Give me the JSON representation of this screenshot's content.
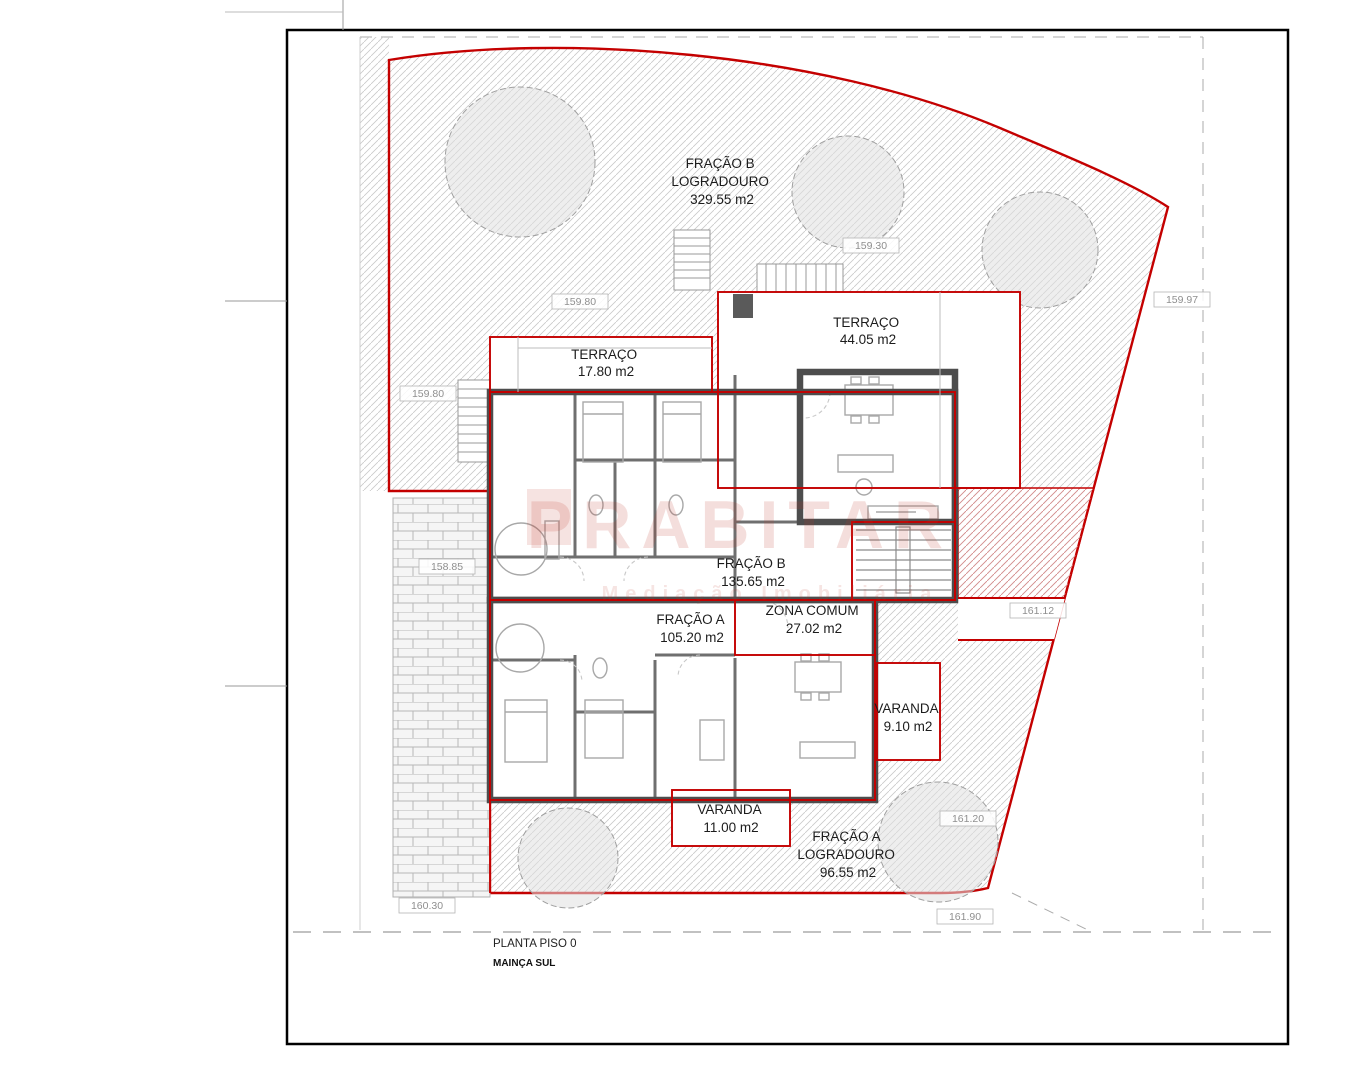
{
  "drawing": {
    "title_block": {
      "line1": "PLANTA PISO 0",
      "line2": "MAINÇA SUL"
    },
    "watermark": {
      "text": "PRABITAR",
      "subtext": "Mediação Imobiliária"
    },
    "areas": [
      {
        "name": "fracao-b-logradouro",
        "lines": [
          "FRAÇÃO B",
          "LOGRADOURO",
          "329.55 m2"
        ]
      },
      {
        "name": "terraco-fracao-b",
        "lines": [
          "TERRAÇO",
          "44.05 m2"
        ]
      },
      {
        "name": "terraco-fracao-b-2",
        "lines": [
          "TERRAÇO",
          "17.80 m2"
        ]
      },
      {
        "name": "fracao-b",
        "lines": [
          "FRAÇÃO B",
          "135.65 m2"
        ]
      },
      {
        "name": "zona-comum",
        "lines": [
          "ZONA COMUM",
          "27.02 m2"
        ]
      },
      {
        "name": "fracao-a",
        "lines": [
          "FRAÇÃO A",
          "105.20 m2"
        ]
      },
      {
        "name": "varanda-fracao-b",
        "lines": [
          "VARANDA",
          "9.10 m2"
        ]
      },
      {
        "name": "varanda-fracao-a",
        "lines": [
          "VARANDA",
          "11.00 m2"
        ]
      },
      {
        "name": "fracao-a-logradouro",
        "lines": [
          "FRAÇÃO A",
          "LOGRADOURO",
          "96.55 m2"
        ]
      }
    ],
    "elevations": [
      "159.30",
      "159.80",
      "159.97",
      "159.80",
      "158.85",
      "161.12",
      "161.20",
      "160.30",
      "161.90"
    ],
    "colors": {
      "boundary_red": "#c40000",
      "wall_gray": "#4d4d4d",
      "hatch_gray": "#c8c8c8",
      "watermark_red": "#c0392b"
    }
  }
}
